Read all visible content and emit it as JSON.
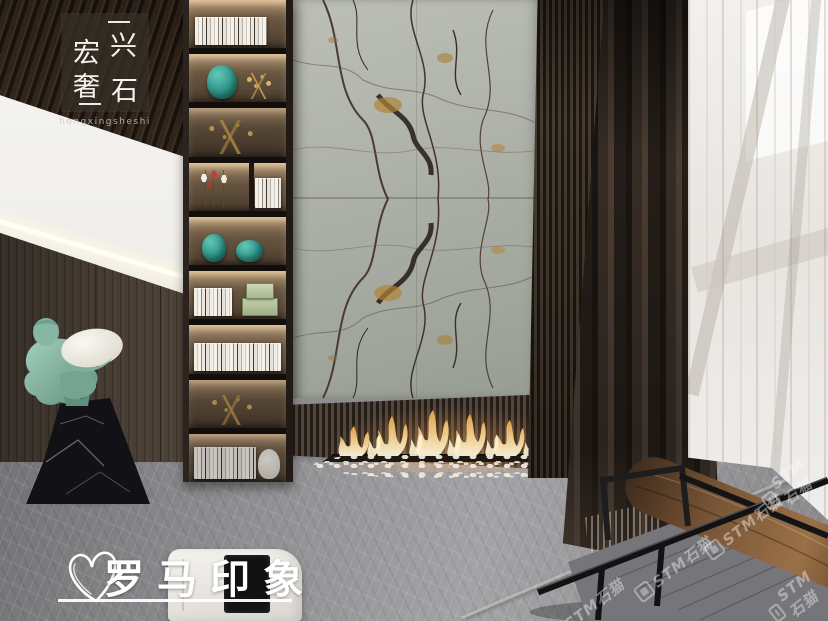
{
  "branding": {
    "logo_badge": {
      "char_1": "宏",
      "char_2": "兴",
      "char_3": "奢",
      "char_4": "石",
      "romanized": "hongxingsheshi"
    },
    "caption": {
      "text": "罗马印象"
    },
    "watermark": {
      "text": "STM石猫"
    }
  },
  "palette": {
    "statue_teal": "#8cbfad",
    "marble_base": "#aeb2a9",
    "marble_vein": "#45362e",
    "marble_gold": "#b08438",
    "flame": "#f4c87a",
    "curtain_brown": "#34291f",
    "wood_wall": "#46392e",
    "floor_gray": "#8d8c8f"
  }
}
